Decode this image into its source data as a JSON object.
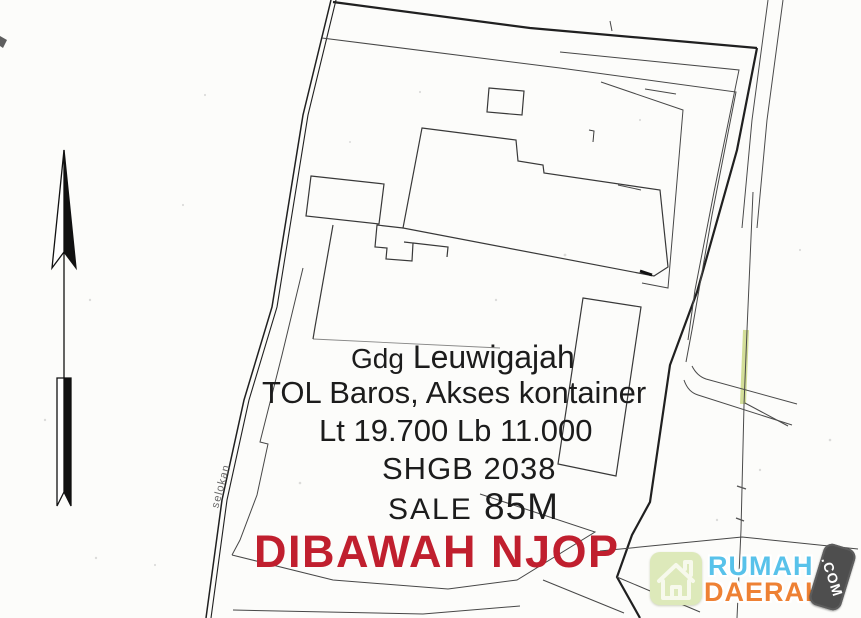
{
  "plan": {
    "labels": {
      "waterway": "selokan"
    },
    "annotation": {
      "building_prefix": "Gdg",
      "building_name": "Leuwigajah",
      "access_line": "TOL Baros, Akses kontainer",
      "area_line": "Lt 19.700 Lb 11.000",
      "certificate_line": "SHGB 2038",
      "sale_label": "SALE",
      "sale_value": "85M",
      "highlight_line": "DIBAWAH NJOP"
    },
    "colors": {
      "highlight_text": "#c01f2e",
      "ink": "#3d3d3d",
      "boundary_ink": "#202020",
      "marker_highlight": "#c8d67f"
    }
  },
  "compass": {
    "icon": "north-arrow-icon",
    "direction": "up"
  },
  "watermark": {
    "brand_primary": "RUMAH",
    "brand_secondary": "DAERAH",
    "domain_suffix": ".COM",
    "icons": {
      "house": "house-icon"
    },
    "colors": {
      "primary": "#58c2ea",
      "secondary": "#ee8134",
      "tile": "#dde9ba",
      "tag": "#4e4e4e"
    }
  }
}
